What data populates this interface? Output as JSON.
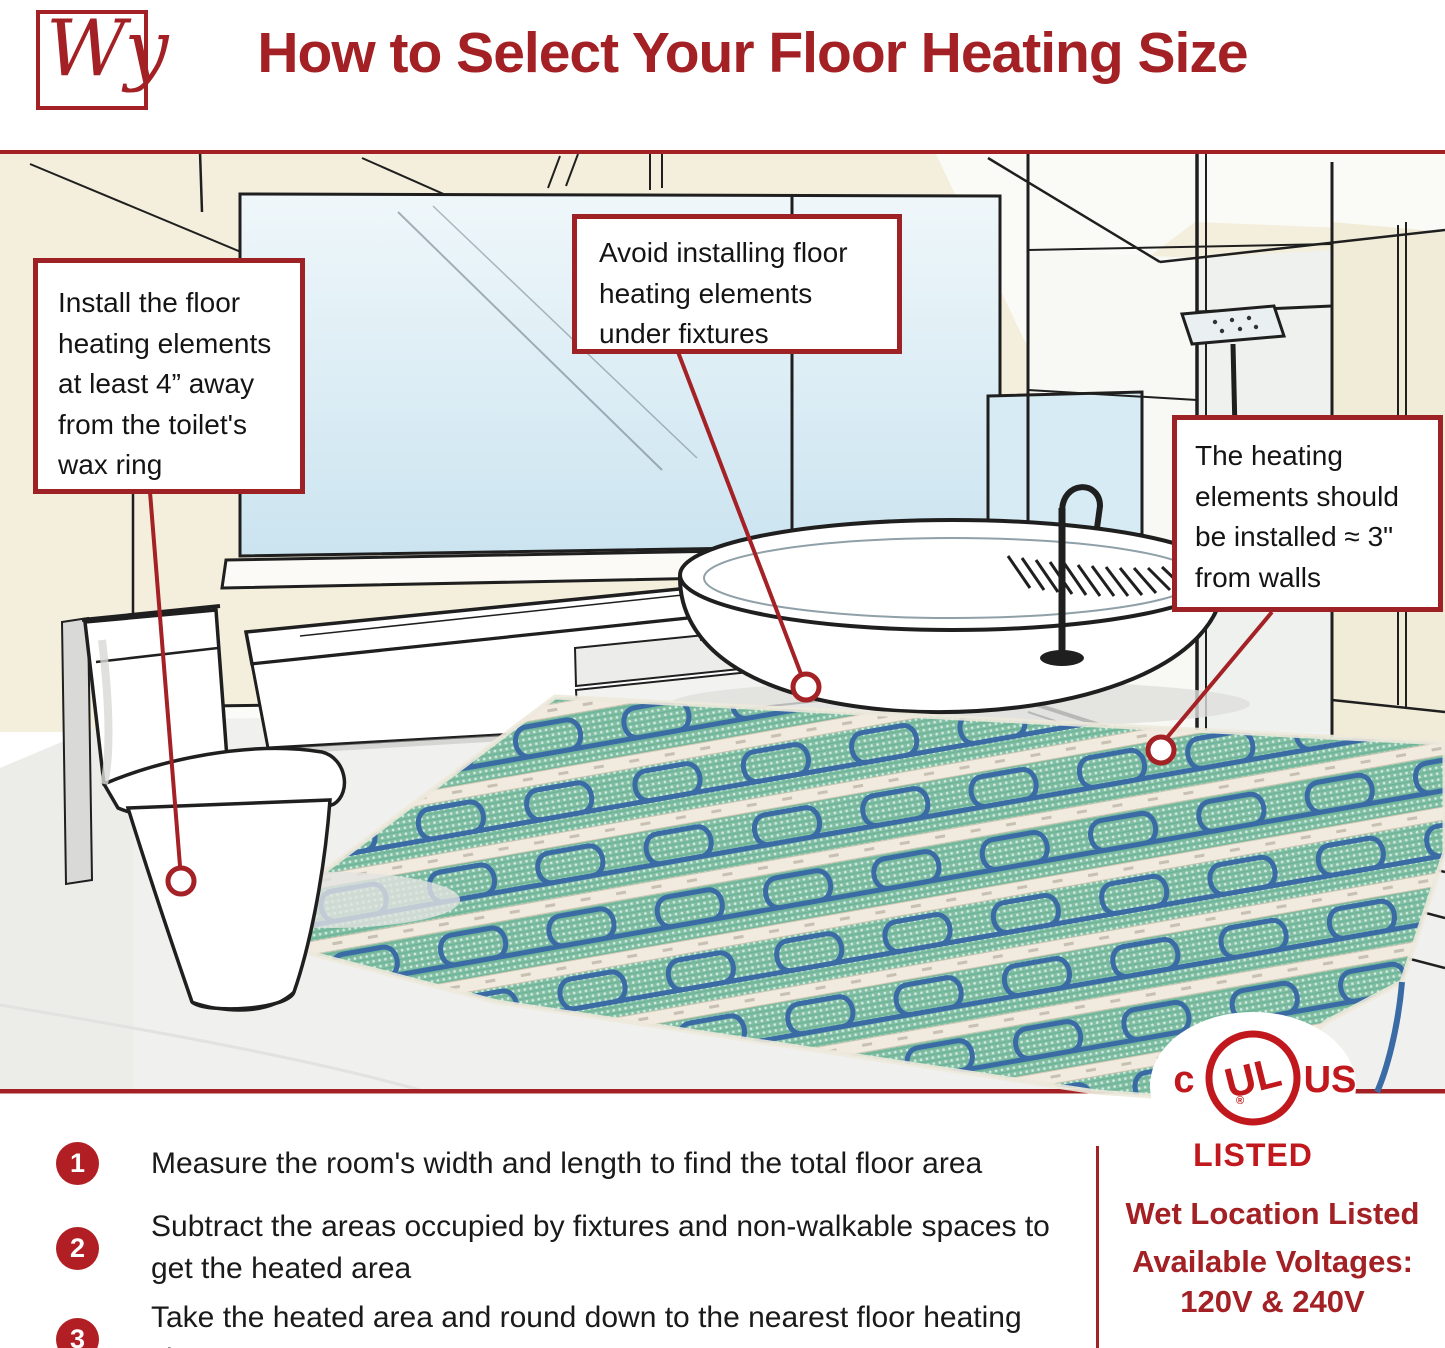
{
  "colors": {
    "accent_red": "#A32024",
    "callout_border_red": "#9E2225",
    "badge_red": "#B11F24",
    "ul_red": "#C0181C",
    "wall_cream": "#F4EFDC",
    "glass_blue": "#D8EBF4",
    "mat_green": "#7FBEA3",
    "cable_blue": "#3A6BA5"
  },
  "header": {
    "logo_text": "Wy",
    "title": "How to Select Your Floor Heating Size"
  },
  "callouts": {
    "toilet": "Install the floor heating elements at least 4” away from the toilet's wax ring",
    "fixtures": "Avoid installing floor heating elements under fixtures",
    "walls": "The heating elements should be installed ≈ 3\" from walls"
  },
  "certification": {
    "c": "c",
    "ul": "UL",
    "registered": "®",
    "us": "US",
    "listed": "LISTED"
  },
  "steps": {
    "items": [
      {
        "number": "1",
        "text": "Measure the room's width and length to find the total floor area"
      },
      {
        "number": "2",
        "text": "Subtract the areas occupied by fixtures and non-walkable spaces to get the heated area"
      },
      {
        "number": "3",
        "text": "Take the heated area and round down to the nearest floor heating size"
      }
    ]
  },
  "footer": {
    "wet_location": "Wet Location Listed",
    "voltages_label": "Available Voltages:",
    "voltages_value": "120V & 240V"
  }
}
